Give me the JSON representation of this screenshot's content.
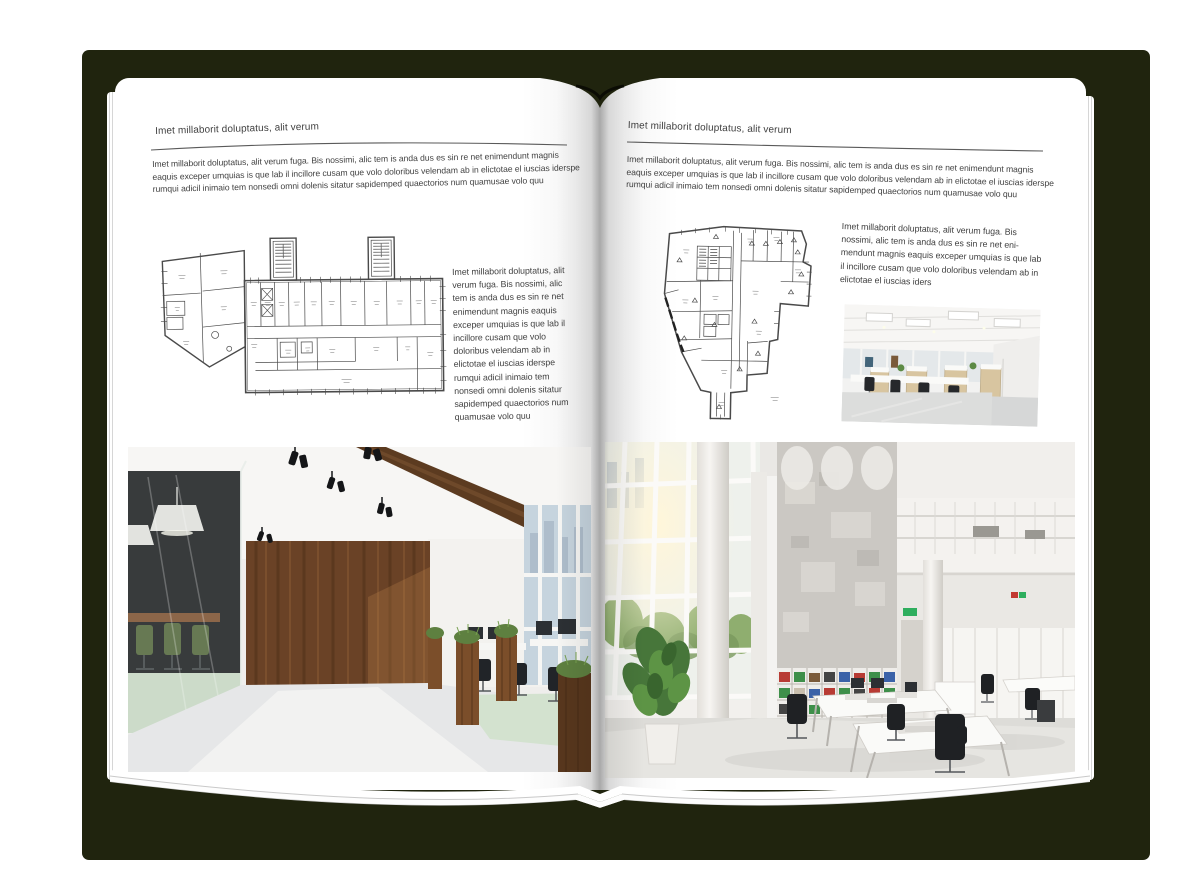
{
  "document": {
    "type": "open-brochure-mockup",
    "colors": {
      "backdrop": "#20240e",
      "paper": "#ffffff",
      "text": "#414141",
      "rule": "#5a5a5a"
    }
  },
  "left_page": {
    "header": "Imet millaborit doluptatus, alit verum",
    "intro": "Imet millaborit doluptatus, alit verum fuga. Bis nossimi, alic tem is anda dus es sin re net enimendunt magnis eaquis exceper umquias is que lab il incillore cusam que volo doloribus velendam ab in elictotae el iuscias iderspe rumqui adicil inimaio tem nonsedi omni dolenis sitatur sapidemped quaectorios num quamusae volo quu",
    "side_text": "Imet millaborit doluptatus, alit verum fuga. Bis nossimi, alic tem is anda dus es sin re net enimendunt magnis eaquis exceper umquias is que lab il incillore cusam que volo doloribus velendam ab in elictotae el iuscias iderspe rumqui adicil inimaio tem nonsedi omni dolenis sitatur sapidemped quaectorios num quamusae volo quu"
  },
  "right_page": {
    "header": "Imet millaborit doluptatus, alit verum",
    "intro": "Imet millaborit doluptatus, alit verum fuga. Bis nossimi, alic tem is anda dus es sin re net enimendunt magnis eaquis exceper umquias is que lab il incillore cusam que volo doloribus velendam ab in elictotae el iuscias iderspe rumqui adicil inimaio tem nonsedi omni dolenis sitatur sapidemped quaectorios num quamusae volo quu",
    "side_text": "Imet millaborit doluptatus, alit verum fuga. Bis nossimi, alic tem is anda dus es sin re net eni­mendunt magnis eaquis exceper umquias is que lab il incillore cusam que volo doloribus velendam ab in elictotae el iuscias iders"
  }
}
